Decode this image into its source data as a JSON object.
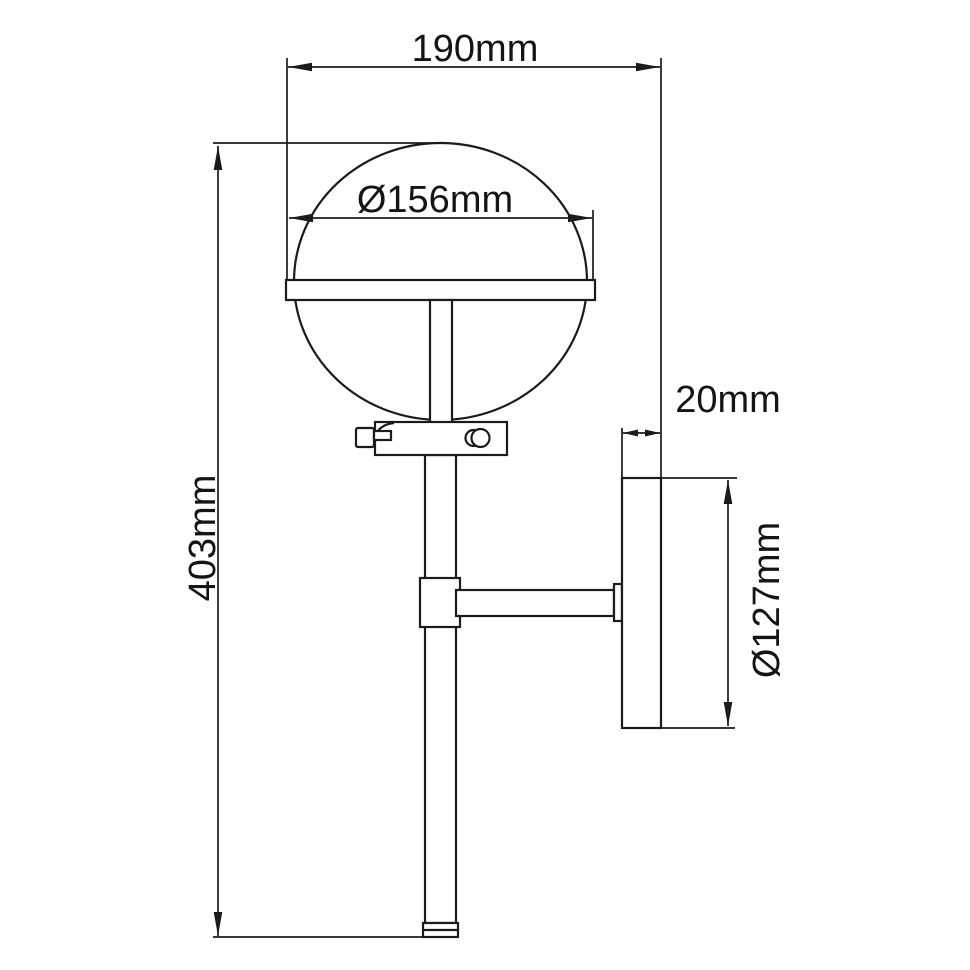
{
  "drawing": {
    "title": "wall-light-dimension-drawing",
    "colors": {
      "background": "#ffffff",
      "line": "#1b1b1b",
      "text": "#141414"
    },
    "labels": {
      "overall_projection": "190mm",
      "globe_diameter": "Ø156mm",
      "overall_height": "403mm",
      "backplate_depth": "20mm",
      "backplate_diameter": "Ø127mm"
    }
  }
}
